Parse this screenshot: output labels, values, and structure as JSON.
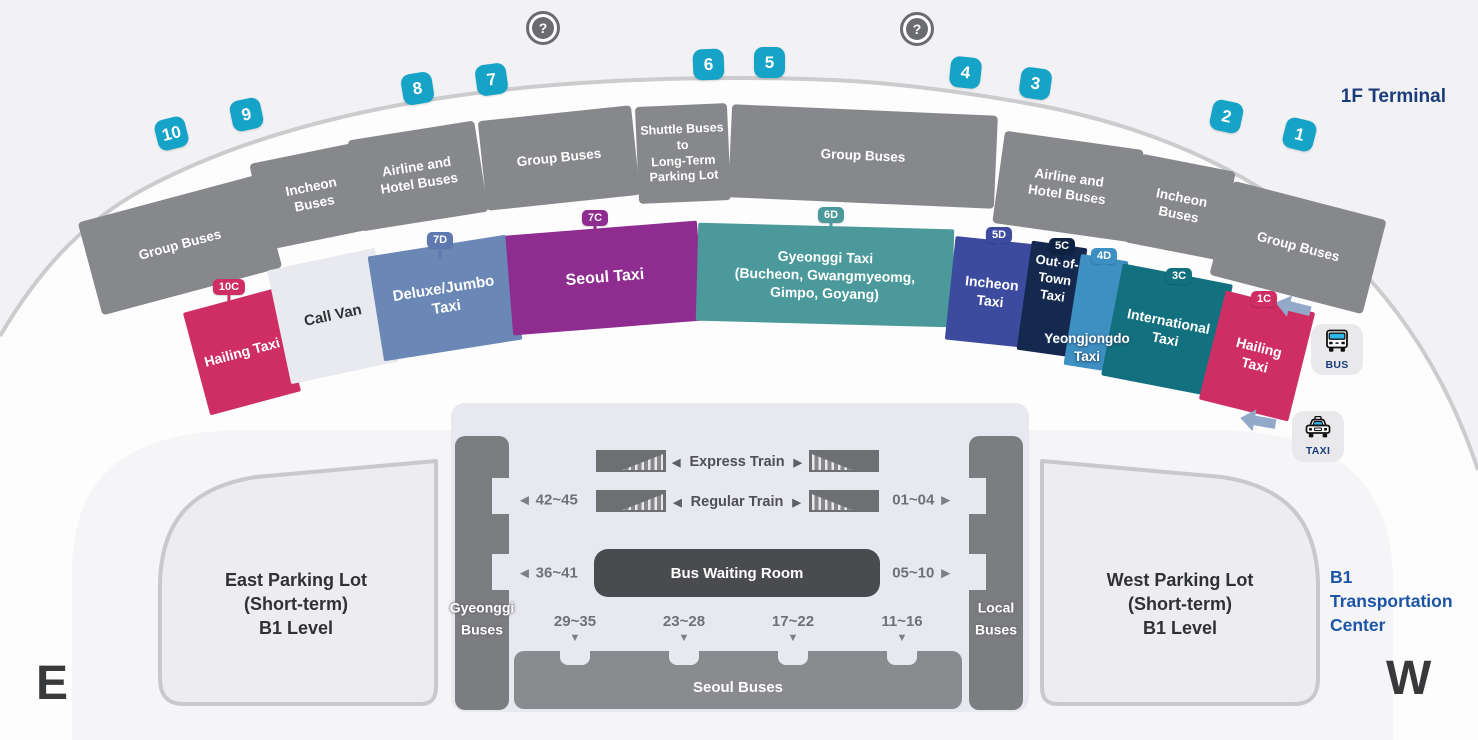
{
  "terminal": {
    "title": "1F Terminal",
    "help_icon": "?",
    "gate_numbers": [
      "10",
      "9",
      "8",
      "7",
      "6",
      "5",
      "4",
      "3",
      "2",
      "1"
    ],
    "curbside": [
      {
        "label": "Group Buses"
      },
      {
        "label": "Incheon Buses"
      },
      {
        "label": "Airline and Hotel Buses"
      },
      {
        "label": "Group Buses"
      },
      {
        "lines": [
          "Shuttle Buses to",
          "Long-Term",
          "Parking Lot"
        ]
      },
      {
        "label": "Group Buses"
      },
      {
        "label": "Airline and Hotel Buses"
      },
      {
        "label": "Incheon Buses"
      },
      {
        "label": "Group Buses"
      }
    ],
    "taxi_zones": [
      {
        "code": "10C",
        "label": "Hailing Taxi",
        "color": "#ce2e63"
      },
      {
        "code": "",
        "label": "Call Van",
        "color": "#e9eaef"
      },
      {
        "code": "7D",
        "label": "Deluxe/Jumbo Taxi",
        "color": "#6a87b5"
      },
      {
        "code": "7C",
        "label": "Seoul Taxi",
        "color": "#8e2c90"
      },
      {
        "code": "6D",
        "label": "Gyeonggi Taxi (Bucheon, Gwangmyeomg, Gimpo, Goyang)",
        "lines": [
          "Gyeonggi Taxi",
          "(Bucheon, Gwangmyeomg,",
          "Gimpo, Goyang)"
        ],
        "color": "#4b999a"
      },
      {
        "code": "5D",
        "label": "Incheon Taxi",
        "color": "#3c4b9e"
      },
      {
        "code": "5C",
        "label": "Out-of-Town Taxi",
        "color": "#15294f"
      },
      {
        "code": "4D",
        "label": "Yeongjongdo Taxi",
        "lines": [
          "Yeongjongdo",
          "Taxi"
        ],
        "color": "#3e90c3"
      },
      {
        "code": "3C",
        "label": "International Taxi",
        "color": "#13707e"
      },
      {
        "code": "1C",
        "label": "Hailing Taxi",
        "color": "#ce2e63"
      }
    ]
  },
  "buttons": {
    "bus": "BUS",
    "taxi": "TAXI"
  },
  "center": {
    "express_train": "Express Train",
    "regular_train": "Regular Train",
    "bus_waiting_room": "Bus Waiting Room",
    "seoul_buses": "Seoul Buses",
    "gyeonggi_buses_lines": [
      "Gyeonggi",
      "Buses"
    ],
    "local_buses_lines": [
      "Local",
      "Buses"
    ],
    "platforms": {
      "left_top": "42~45",
      "right_top": "01~04",
      "left_bottom": "36~41",
      "right_bottom": "05~10"
    },
    "stops": [
      "29~35",
      "23~28",
      "17~22",
      "11~16"
    ],
    "label_lines": [
      "B1",
      "Transportation",
      "Center"
    ]
  },
  "parking": {
    "east_lines": [
      "East Parking Lot",
      "(Short-term)",
      "B1 Level"
    ],
    "west_lines": [
      "West Parking Lot",
      "(Short-term)",
      "B1 Level"
    ]
  },
  "compass": {
    "east": "E",
    "west": "W"
  },
  "glyphs": {
    "left": "◀",
    "right": "▶",
    "down": "▼"
  },
  "colors": {
    "accent_cyan": "#16a3c8",
    "navy_text": "#1b3c7a",
    "blue_text": "#1d55a6"
  }
}
